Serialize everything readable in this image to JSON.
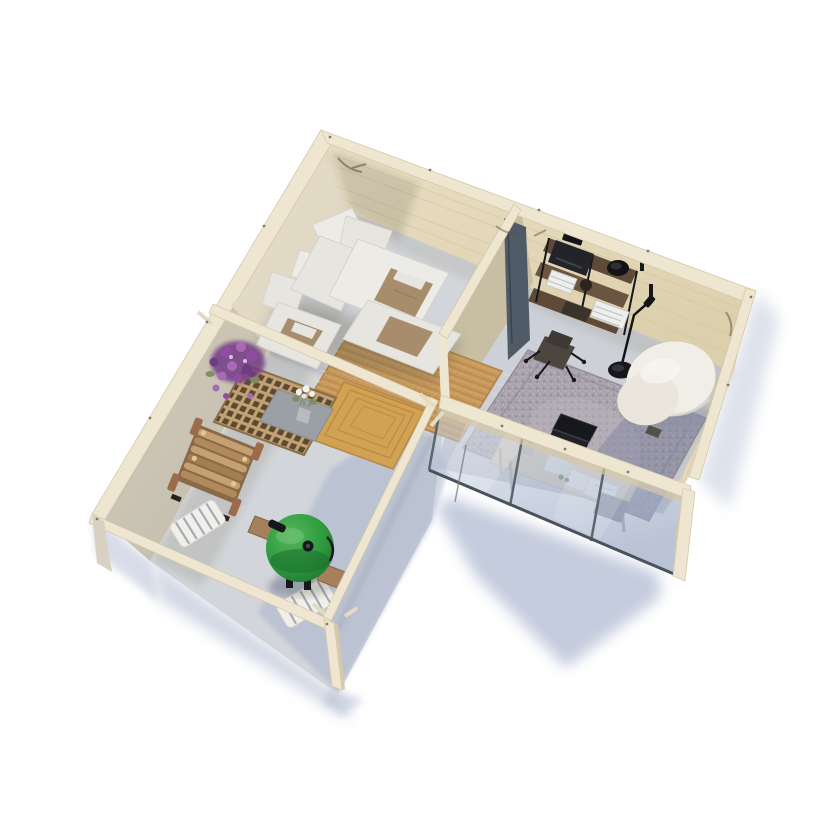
{
  "scene": {
    "title": "Top-down 3D render of an L-shaped garden house: lounge room with corner sofa, glazed home office, and open pergola patio with grill",
    "rooms": [
      {
        "name": "lounge",
        "items": [
          "corner-sofa",
          "back-cushions",
          "tan-throw-blankets",
          "jute-rug",
          "partition-door"
        ]
      },
      {
        "name": "office",
        "items": [
          "wall-shelf-unit",
          "typewriter",
          "black-bowl",
          "books",
          "desk-chair",
          "floor-lamp",
          "gray-vintage-rug",
          "laptop",
          "boucle-lounge-chair",
          "glass-wall-desk",
          "potted-plant",
          "papers",
          "notebook"
        ]
      },
      {
        "name": "patio",
        "items": [
          "pergola-beams",
          "lattice-coffee-table",
          "white-flower-vase",
          "petunia-flowers",
          "firewood-rack",
          "kamado-grill",
          "striped-folding-chairs",
          "spiral-jute-rug"
        ]
      }
    ]
  },
  "colors": {
    "crown": "#efe6d1",
    "crown_hi": "#f8f2e1",
    "crown_shade": "#d6c9aa",
    "wall_warm": "#e9dfc4",
    "wall_warm2": "#e2d9c4",
    "wall_se": "#e4d9bc",
    "wall_part": "#ddd2b6",
    "plank": "#d3c5a4",
    "floor": "#d2d5d9",
    "floor_office": "#cdd1d7",
    "door": "#505b68",
    "sofa": "#e7e5e0",
    "sofa_lt": "#edebe6",
    "sofa_shadow": "#55514a",
    "throw": "#a78d6c",
    "jute": "#c89a5c",
    "jute_dark": "#b0834a",
    "jute_spiral": "#d2a254",
    "rug_gray": "#a8a2ab",
    "rug_gray_lt": "#bcb6bf",
    "rug_gray_dk": "#8f8998",
    "tray": "#9aa0a6",
    "wood_dark": "#5f4a37",
    "shelf_mid": "#6b5440",
    "log": "#c5a171",
    "log_dark": "#8a6848",
    "rack_post": "#9c6b4a",
    "lattice_wood": "#c0a274",
    "lattice_hole": "#5e4930",
    "grill_hi": "#55b65c",
    "grill": "#2e9b3f",
    "grill_dk": "#1c6e2d",
    "shelfwood": "#a5805a",
    "mat": "#f1efe9",
    "mat_stripe": "#97a1b0",
    "black": "#17181c",
    "paper": "#eceef0",
    "desk": "#d9ccb5",
    "plant": "#6a8a52",
    "chair_boucle": "#f1eee7",
    "chair_boucle_dk": "#ddd8cd",
    "glass_lt": "#cdd7e8",
    "glass_dk": "#96a5c0",
    "frame_metal": "#5b6570",
    "shadow_blue": "#b1bbd2",
    "shadow_warm": "#9a968c",
    "shadow_floor": "#aab4cd",
    "screw": "#857b62",
    "petunia1": "#8e4d9f",
    "petunia2": "#a969b6",
    "petunia3": "#713a84",
    "flower_white": "#f2f3ef",
    "green": "#7c8a5c"
  }
}
